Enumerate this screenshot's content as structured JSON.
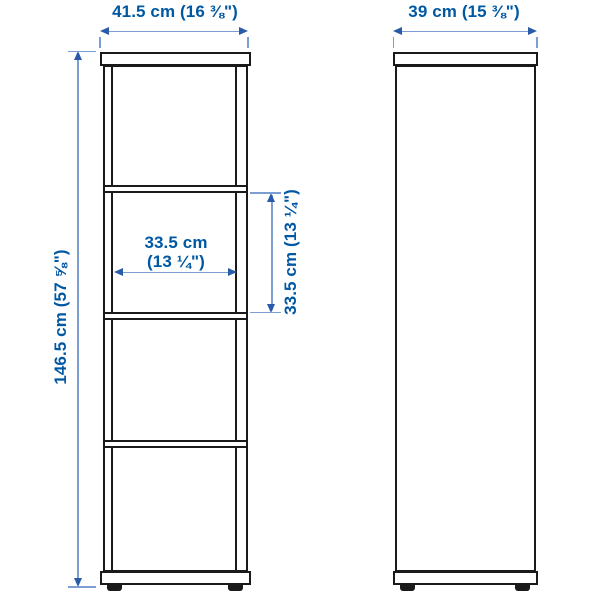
{
  "colors": {
    "outline": "#1a1a1a",
    "dimension_text": "#0058a3",
    "dimension_line": "#7d9ed2",
    "dimension_arrow": "#2a5ba8",
    "background": "#ffffff"
  },
  "front_view": {
    "width_label": "41.5 cm (16 ⅜\")",
    "height_label": "146.5 cm (57 ⅝\")",
    "inner_width_label": [
      "33.5 cm",
      "(13 ¼\")"
    ],
    "inner_height_label": "33.5 cm (13 ¼\")"
  },
  "side_view": {
    "depth_label": "39 cm (15 ⅜\")"
  }
}
